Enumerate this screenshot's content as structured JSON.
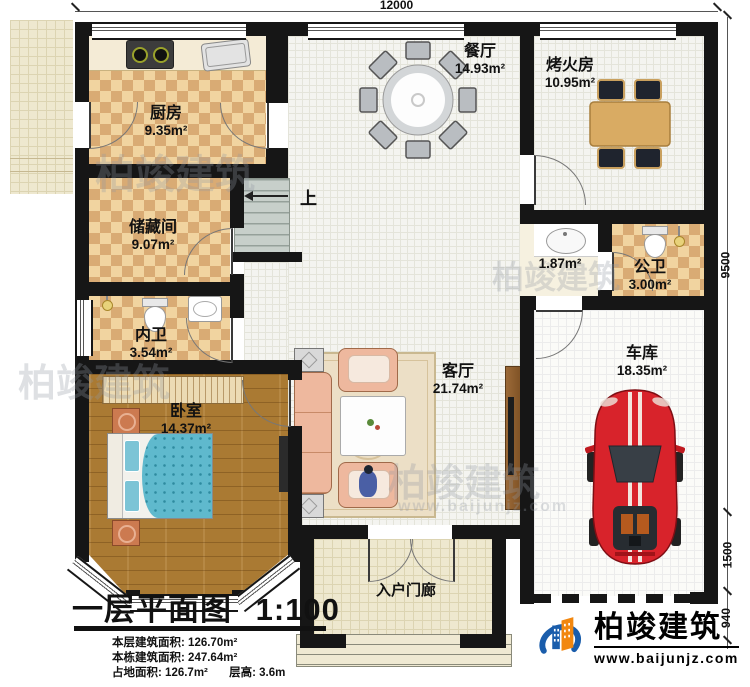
{
  "dims": {
    "top": "12000",
    "right_main": "9500",
    "right_mid": "1500",
    "right_low": "940"
  },
  "rooms": {
    "kitchen": {
      "name": "厨房",
      "area": "9.35m²"
    },
    "dining": {
      "name": "餐厅",
      "area": "14.93m²"
    },
    "fire": {
      "name": "烤火房",
      "area": "10.95m²"
    },
    "storage": {
      "name": "储藏间",
      "area": "9.07m²"
    },
    "bath_private": {
      "name": "内卫",
      "area": "3.54m²"
    },
    "bedroom": {
      "name": "卧室",
      "area": "14.37m²"
    },
    "living": {
      "name": "客厅",
      "area": "21.74m²"
    },
    "vanity": {
      "area": "1.87m²"
    },
    "bath_public": {
      "name": "公卫",
      "area": "3.00m²"
    },
    "garage": {
      "name": "车库",
      "area": "18.35m²"
    },
    "porch": {
      "name": "入户门廊"
    }
  },
  "stairs": {
    "up_label": "上"
  },
  "titleblock": {
    "title": "一层平面图",
    "scale": "1:100",
    "stats": [
      {
        "label": "本层建筑面积:",
        "value": "126.70m²"
      },
      {
        "label": "本栋建筑面积:",
        "value": "247.64m²"
      },
      {
        "label": "占地面积:",
        "value": "126.7m²"
      },
      {
        "label": "层高:",
        "value": "3.6m"
      }
    ]
  },
  "logo": {
    "name": "柏竣建筑",
    "url": "www.baijunjz.com"
  },
  "watermark": {
    "name": "柏竣建筑",
    "url": "www.baijunjz.com"
  },
  "colors": {
    "wall": "#161616",
    "checker_dark": "#d9ab74",
    "checker_light": "#f1d4a0",
    "wood": "#aa7a33",
    "bed": "#5fb9cd",
    "sofa": "#eeb89e",
    "car": "#d8232b",
    "logo_blue": "#1a5dab",
    "logo_orange": "#f2870f"
  }
}
